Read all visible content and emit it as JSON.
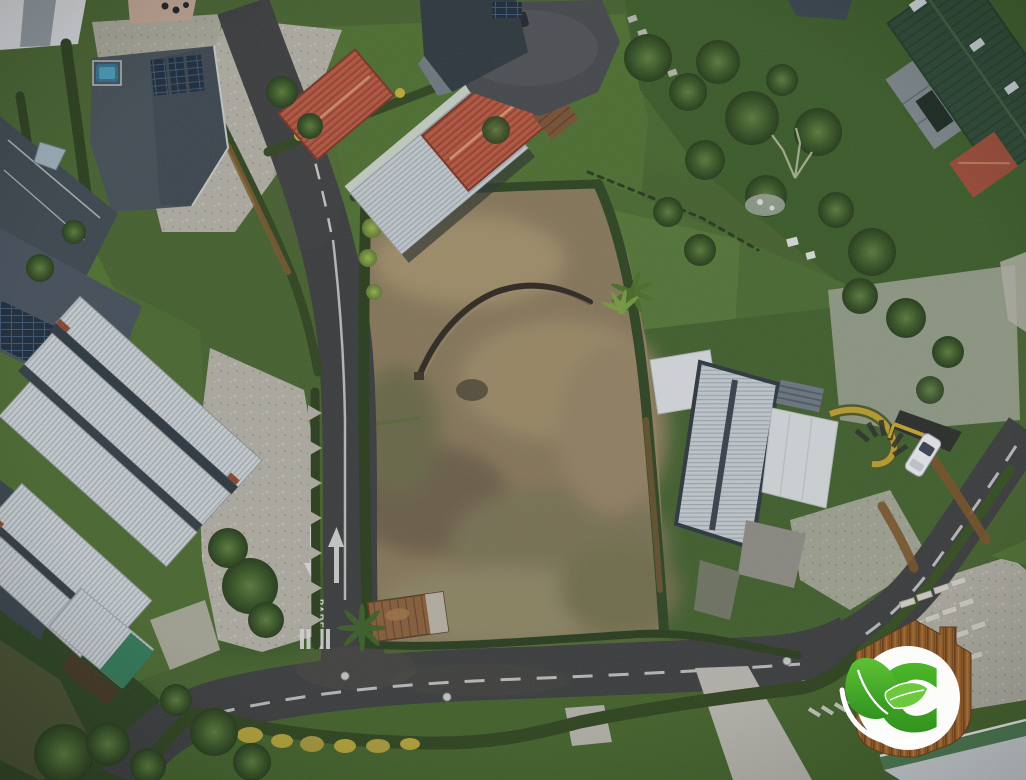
{
  "image": {
    "kind": "aerial-drone-photograph",
    "scene": "vacant-dirt-lot-surrounded-by-upscale-homes-hedges-and-curving-roads"
  },
  "road_markings": {
    "stop_text": "PARE"
  },
  "logo": {
    "letter": "C"
  },
  "palette": {
    "grass_base": "#47632e",
    "asphalt": "#3b3d3e",
    "lot_soil": "#8a795a",
    "red_roof": "#b0513a",
    "white_metal_roof": "#ccd1d5",
    "barn_green_roof": "#2c4732",
    "dark_modern_roof": "#454e56",
    "hedge_green": "#2b3f1c",
    "gravel": "#b2aea3",
    "logo_wood": "#8a5a2c",
    "logo_green": "#3fae27",
    "marking_white": "#dcdcda"
  },
  "scene_elements": [
    "modern-dark-roof-house",
    "red-tile-roof-house",
    "green-roof-barn",
    "white-metal-roof-house-cluster",
    "modern-white-roof-house",
    "vacant-dirt-lot",
    "curved-trench",
    "hedgerows",
    "gravel-driveway",
    "cul-de-sac",
    "parked-cars",
    "stop-road-marking",
    "crosswalk",
    "eco-house-logo-watermark"
  ]
}
